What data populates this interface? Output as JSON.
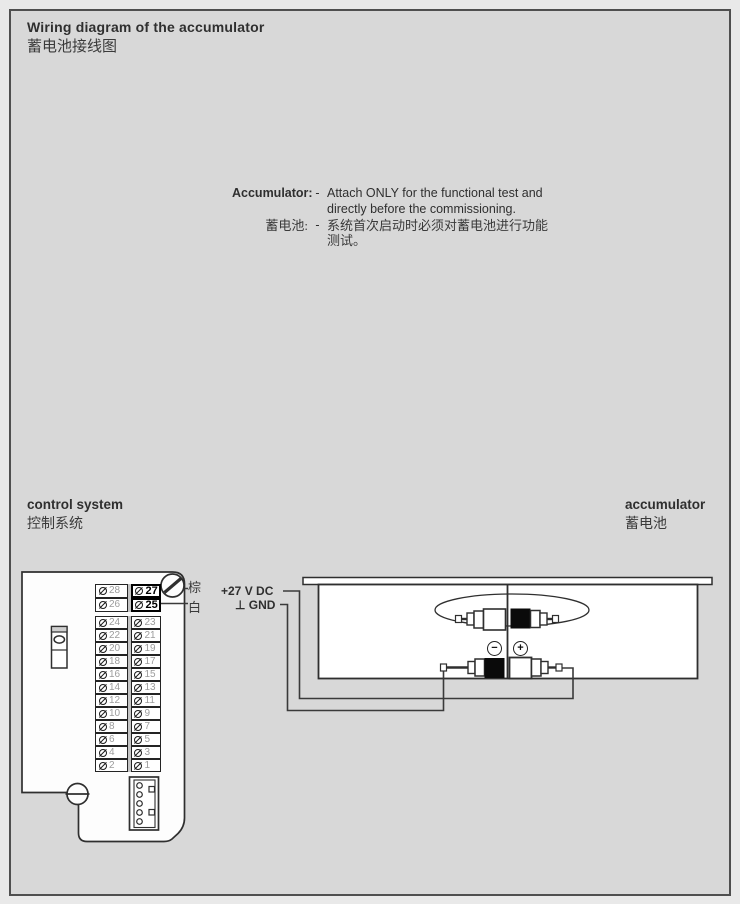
{
  "page": {
    "title_en": "Wiring diagram of the accumulator",
    "title_zh": "蓄电池接线图"
  },
  "note": {
    "label_en": "Accumulator:",
    "label_zh": "蓄电池:",
    "dash": "-",
    "line1_en": "Attach ONLY for the functional test and",
    "line2_en": "directly before the commissioning.",
    "line1_zh": "系统首次启动时必须对蓄电池进行功能",
    "line2_zh": "测试。"
  },
  "labels": {
    "control_system_en": "control system",
    "control_system_zh": "控制系统",
    "accumulator_en": "accumulator",
    "accumulator_zh": "蓄电池",
    "wire_brown": "棕",
    "wire_white": "白",
    "supply": "+27 V DC",
    "ground": "⊥ GND",
    "minus": "−",
    "plus": "+"
  },
  "terminal_block": {
    "rows": [
      {
        "left": "28",
        "right": "27",
        "highlight": true
      },
      {
        "left": "26",
        "right": "25",
        "highlight": true
      },
      {
        "left": "24",
        "right": "23"
      },
      {
        "left": "22",
        "right": "21"
      },
      {
        "left": "20",
        "right": "19"
      },
      {
        "left": "18",
        "right": "17"
      },
      {
        "left": "16",
        "right": "15"
      },
      {
        "left": "14",
        "right": "13"
      },
      {
        "left": "12",
        "right": "11"
      },
      {
        "left": "10",
        "right": "9"
      },
      {
        "left": "8",
        "right": "7"
      },
      {
        "left": "6",
        "right": "5"
      },
      {
        "left": "4",
        "right": "3"
      },
      {
        "left": "2",
        "right": "1"
      }
    ]
  }
}
